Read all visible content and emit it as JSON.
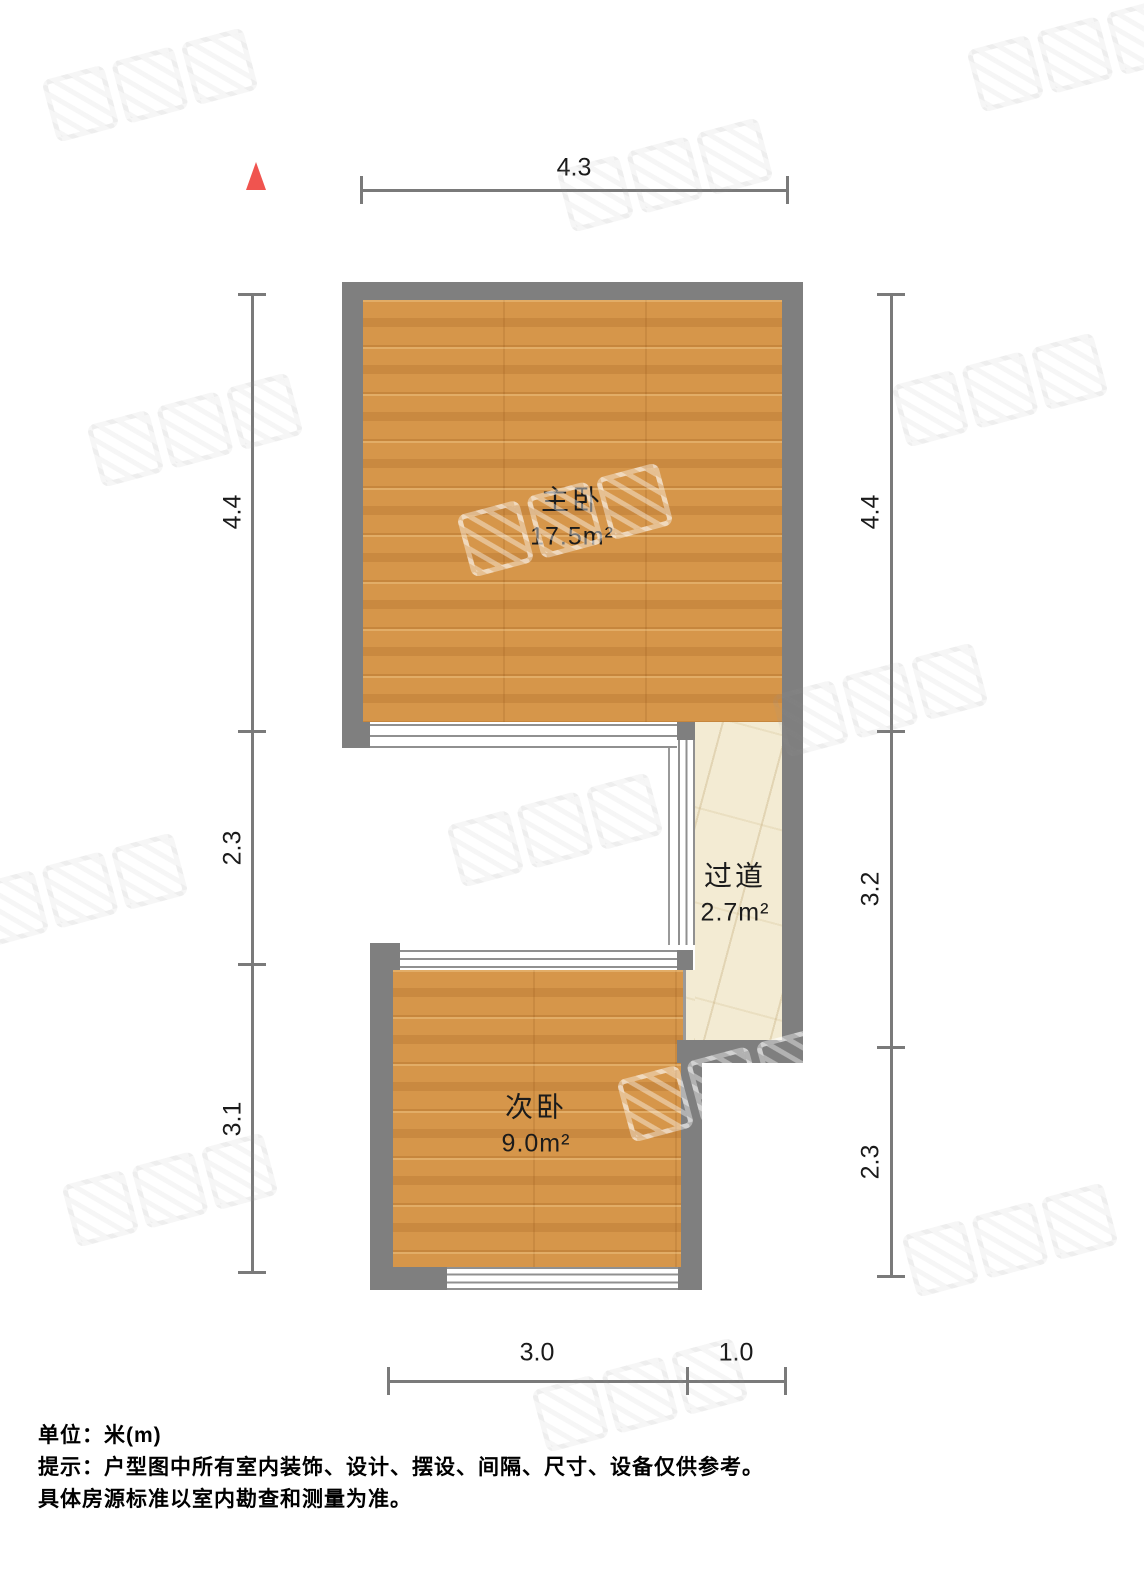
{
  "rooms": [
    {
      "name": "主卧",
      "area": "17.5m²"
    },
    {
      "name": "次卧",
      "area": "9.0m²"
    },
    {
      "name": "过道",
      "area": "2.7m²"
    }
  ],
  "dimensions": {
    "top": [
      "4.3"
    ],
    "left": [
      "4.4",
      "2.3",
      "3.1"
    ],
    "right": [
      "4.4",
      "3.2",
      "2.3"
    ],
    "bottom": [
      "3.0",
      "1.0"
    ]
  },
  "footer": {
    "lines": [
      "单位：米(m)",
      "提示：户型图中所有室内装饰、设计、摆设、间隔、尺寸、设备仅供参考。",
      "具体房源标准以室内勘查和测量为准。"
    ]
  },
  "colors": {
    "wall": "#7f7f7f",
    "wood_floor": "#d6964a",
    "corridor_floor": "#f3ebd3",
    "north_arrow": "#f0544f",
    "dimension_line": "#7a7a7a",
    "text": "#1a1a1a"
  },
  "icons": {
    "north_indicator": "north-triangle"
  },
  "watermark": {
    "positions": [
      [
        150,
        85
      ],
      [
        665,
        175
      ],
      [
        1075,
        55
      ],
      [
        195,
        430
      ],
      [
        565,
        520
      ],
      [
        1000,
        390
      ],
      [
        880,
        700
      ],
      [
        555,
        830
      ],
      [
        80,
        890
      ],
      [
        725,
        1085
      ],
      [
        170,
        1190
      ],
      [
        640,
        1395
      ],
      [
        1010,
        1240
      ]
    ],
    "light_indices": [
      4,
      9
    ]
  }
}
